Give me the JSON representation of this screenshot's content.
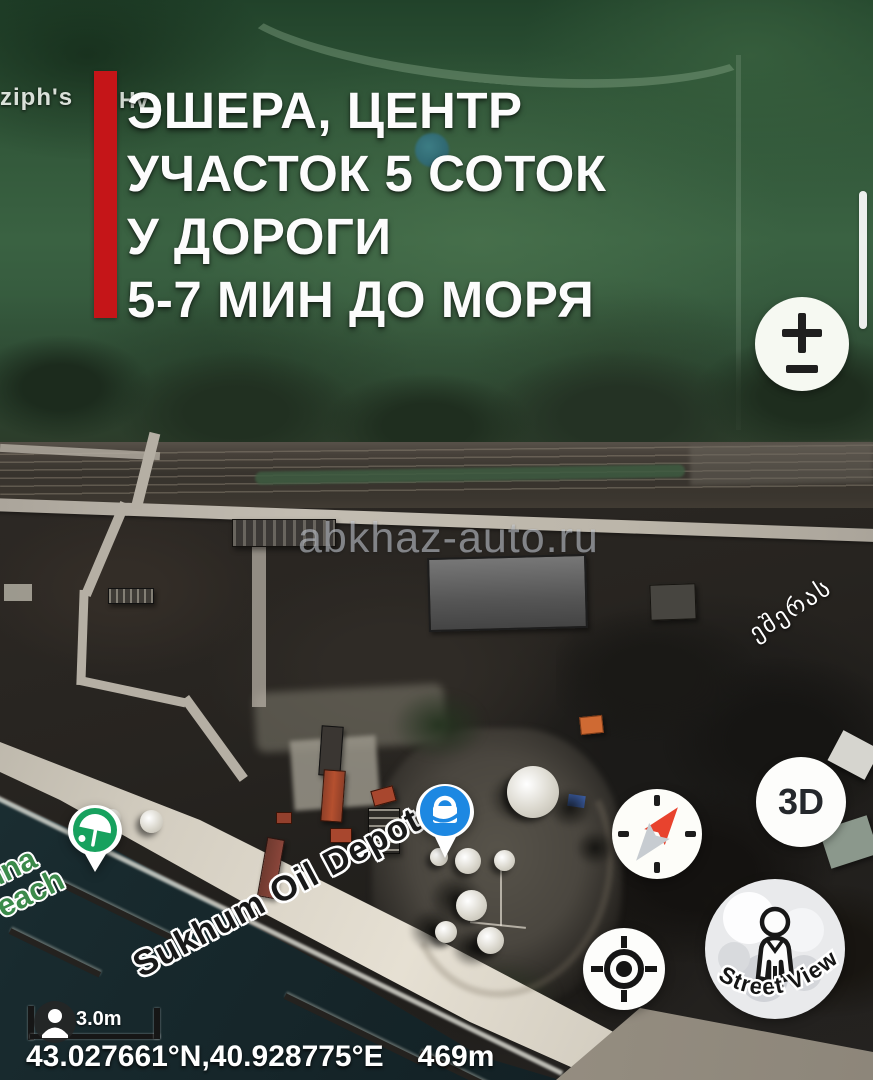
{
  "listing_overlay": {
    "headline_lines": [
      "ЭШЕРА, ЦЕНТР",
      "УЧАСТОК 5 СОТОК",
      "У ДОРОГИ",
      "5-7 МИН ДО МОРЯ"
    ],
    "watermark": "abkhaz-auto.ru",
    "accent_color": "#c51518"
  },
  "map": {
    "labels": {
      "poi_left_fragment": "ziph's",
      "poi_right_fragment": "Hv",
      "georgian_road": "ეშერას",
      "beach_line1": "hna",
      "beach_line2": "each",
      "oil_depot": "Sukhum Oil Depot"
    }
  },
  "controls": {
    "three_d_label": "3D",
    "street_view_label": "Street View"
  },
  "status_bar": {
    "scale_distance": "3.0m",
    "coordinates": "43.027661°N,40.928775°E",
    "altitude": "469m"
  },
  "colors": {
    "accent_red": "#c51518",
    "pin_blue": "#1d88e2",
    "beach_pin_green": "#17a15e"
  }
}
